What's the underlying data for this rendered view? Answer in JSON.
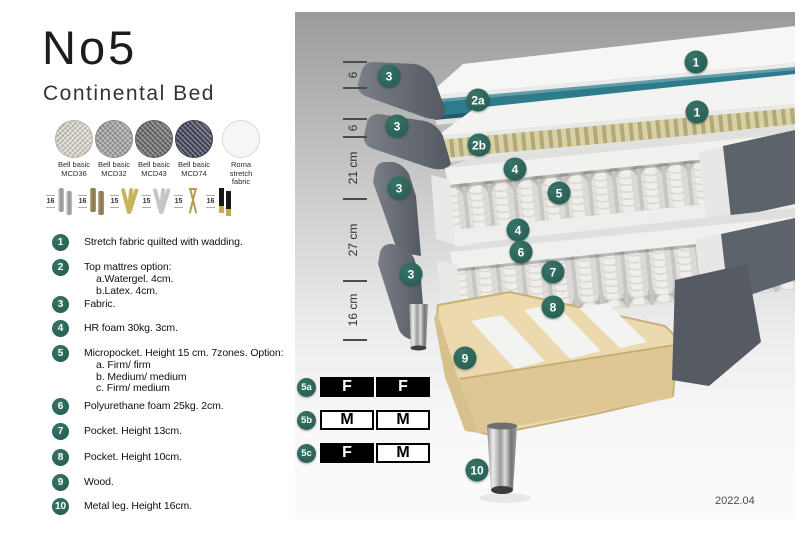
{
  "header": {
    "title": "No5",
    "subtitle": "Continental Bed"
  },
  "fabrics": [
    {
      "name": "Bell basic",
      "code": "MCD36"
    },
    {
      "name": "Bell basic",
      "code": "MCD32"
    },
    {
      "name": "Bell basic",
      "code": "MCD43"
    },
    {
      "name": "Bell basic",
      "code": "MCD74"
    },
    {
      "name": "Roma",
      "code": "stretch fabric"
    }
  ],
  "legs": [
    {
      "height": "16"
    },
    {
      "height": "16"
    },
    {
      "height": "15"
    },
    {
      "height": "15"
    },
    {
      "height": "15"
    },
    {
      "height": "16"
    }
  ],
  "features": [
    {
      "num": "1",
      "lines": [
        "Stretch fabric quilted with wadding."
      ]
    },
    {
      "num": "2",
      "lines": [
        "Top mattres option:",
        "a.Watergel. 4cm.",
        "b.Latex. 4cm."
      ]
    },
    {
      "num": "3",
      "lines": [
        "Fabric."
      ]
    },
    {
      "num": "4",
      "lines": [
        "HR foam 30kg. 3cm."
      ]
    },
    {
      "num": "5",
      "lines": [
        "Micropocket. Height 15 cm. 7zones. Option:",
        "a. Firm/ firm",
        "b. Medium/ medium",
        "c. Firm/ medium"
      ]
    },
    {
      "num": "6",
      "lines": [
        "Polyurethane foam 25kg. 2cm."
      ]
    },
    {
      "num": "7",
      "lines": [
        "Pocket. Height 13cm."
      ]
    },
    {
      "num": "8",
      "lines": [
        "Pocket. Height 10cm."
      ]
    },
    {
      "num": "9",
      "lines": [
        "Wood."
      ]
    },
    {
      "num": "10",
      "lines": [
        "Metal leg. Height 16cm."
      ]
    }
  ],
  "diagram": {
    "badges": [
      {
        "label": "3"
      },
      {
        "label": "2a"
      },
      {
        "label": "1"
      },
      {
        "label": "3"
      },
      {
        "label": "2b"
      },
      {
        "label": "1"
      },
      {
        "label": "4"
      },
      {
        "label": "5"
      },
      {
        "label": "3"
      },
      {
        "label": "4"
      },
      {
        "label": "6"
      },
      {
        "label": "7"
      },
      {
        "label": "3"
      },
      {
        "label": "8"
      },
      {
        "label": "9"
      },
      {
        "label": "10"
      }
    ],
    "scale": [
      {
        "label": "6"
      },
      {
        "label": "6"
      },
      {
        "label": "21 cm"
      },
      {
        "label": "27 cm"
      },
      {
        "label": "16 cm"
      }
    ],
    "tables": [
      {
        "id": "5a",
        "cells": [
          "F",
          "F"
        ]
      },
      {
        "id": "5b",
        "cells": [
          "M",
          "M"
        ]
      },
      {
        "id": "5c",
        "cells": [
          "F",
          "M"
        ]
      }
    ],
    "version": "2022.04",
    "colors": {
      "badge_teal": "#2c6a60",
      "watergel_teal": "#2e7b8c",
      "latex_tan": "#d8d1a3",
      "wood": "#ecd9ae"
    }
  }
}
